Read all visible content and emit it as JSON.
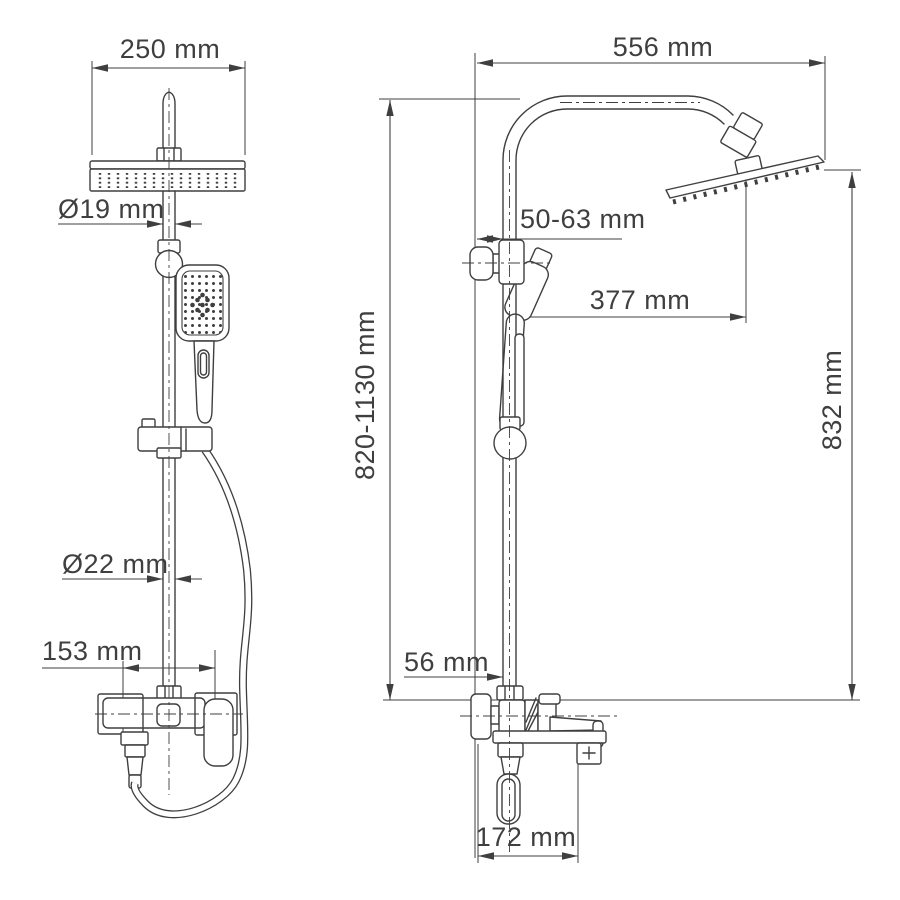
{
  "colors": {
    "line": "#3f3f3f",
    "text": "#3f3f3f",
    "background": "#ffffff"
  },
  "front_view": {
    "dimensions": {
      "head_width": {
        "label": "250 mm",
        "value": 250,
        "unit": "mm"
      },
      "head_pipe_diameter": {
        "label": "Ø19 mm",
        "value": 19,
        "unit": "mm",
        "diameter": true
      },
      "column_diameter": {
        "label": "Ø22 mm",
        "value": 22,
        "unit": "mm",
        "diameter": true
      },
      "inlet_spacing": {
        "label": "153 mm",
        "value": 153,
        "unit": "mm"
      }
    }
  },
  "side_view": {
    "dimensions": {
      "arm_span": {
        "label": "556 mm",
        "value": 556,
        "unit": "mm"
      },
      "wall_to_column": {
        "label": "50-63 mm",
        "min": 50,
        "max": 63,
        "unit": "mm"
      },
      "column_to_head": {
        "label": "377 mm",
        "value": 377,
        "unit": "mm"
      },
      "column_height": {
        "label": "820-1130 mm",
        "min": 820,
        "max": 1130,
        "unit": "mm"
      },
      "head_drop_height": {
        "label": "832 mm",
        "value": 832,
        "unit": "mm"
      },
      "wall_offset_bottom": {
        "label": "56 mm",
        "value": 56,
        "unit": "mm"
      },
      "mixer_depth": {
        "label": "172 mm",
        "value": 172,
        "unit": "mm"
      }
    }
  }
}
